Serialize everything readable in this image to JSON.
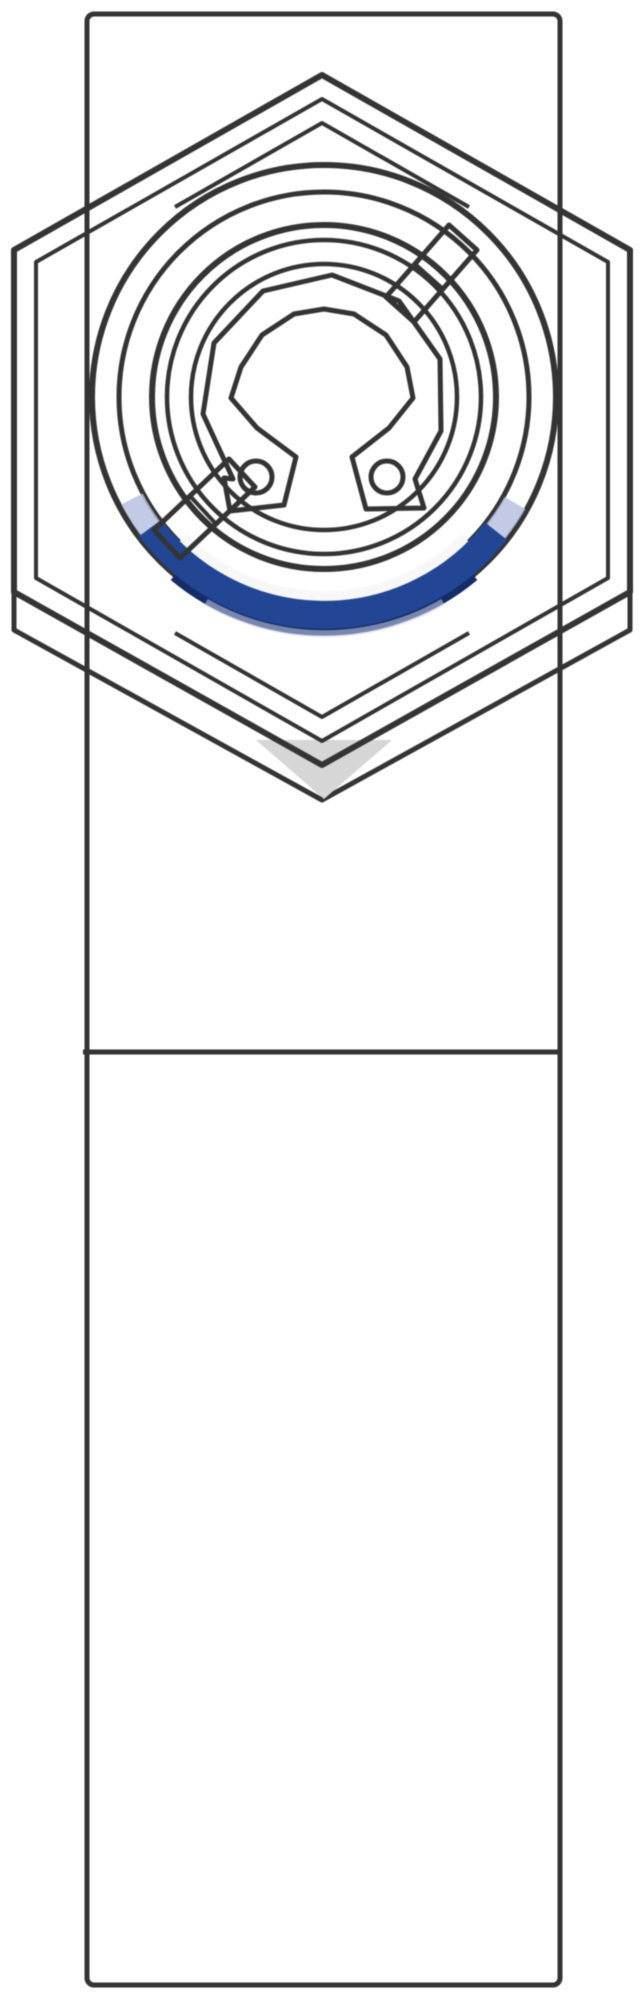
{
  "image": {
    "kind": "technical-illustration",
    "subject": "push-in-fitting-top-view",
    "width_px": 640,
    "height_px": 1995
  },
  "colors": {
    "background": "#ffffff",
    "body_fill": "#e7e7e7",
    "hex_face_light": "#f5f5f5",
    "chamfer_gray": "#e9e9e9",
    "ring_white": "#f7f7f7",
    "inner_gray": "#e9e9e9",
    "clip_fill": "#efefef",
    "slot_white": "#f5f5f5",
    "shadow_gray": "#d6d6d6",
    "under_face": "#f1f1f1",
    "outline": "#343434",
    "blue_main": "#224694",
    "blue_dark": "#152d66",
    "blue_fade": "#b7c1e0",
    "blue_halo": "#ccd2ea"
  },
  "parts": {
    "body": "square-fitting-body",
    "divider": "body-seam-line",
    "nut": "hex-nut",
    "collet": "round-collet-flange",
    "bore": "collet-bore",
    "snap_ring": "c-shaped-retaining-clip",
    "lug_holes": "clip-lug-holes",
    "seal": "blue-seal-ring",
    "slots": "diagonal-key-slots"
  }
}
